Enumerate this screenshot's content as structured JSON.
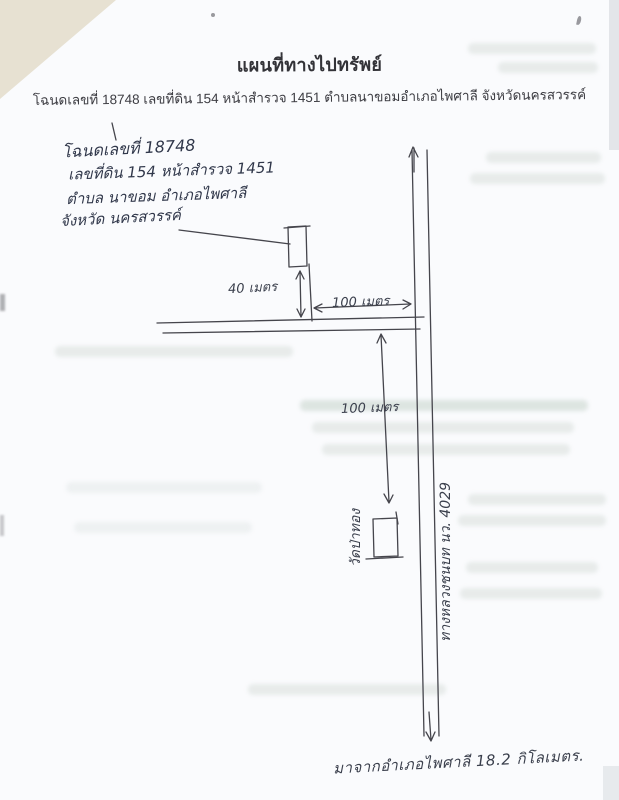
{
  "page": {
    "title": "แผนที่ทางไปทรัพย์",
    "subtitle": "โฉนดเลขที่ 18748 เลขที่ดิน 154 หน้าสำรวจ 1451 ตำบลนาขอมอำเภอไพศาลี จังหวัดนครสวรรค์"
  },
  "handwritten_note": {
    "line1": "โฉนดเลขที่ 18748",
    "line2": "เลขที่ดิน 154 หน้าสำรวจ 1451",
    "line3": "ตำบล นาขอม อำเภอไพศาลี",
    "line4": "จังหวัด นครสวรรค์"
  },
  "map": {
    "label_40m": "40 เมตร",
    "label_100m_horizontal": "100 เมตร",
    "label_100m_vertical": "100 เมตร",
    "temple_label": "วัดป่าทอง",
    "road_label": "ทางหลวงชนบท นว. 4029",
    "bottom_note": "มาจากอำเภอไพศาลี  18.2 กิโลเมตร."
  },
  "colors": {
    "paper": "#fafbfd",
    "printed_text": "#3a3a3e",
    "handwriting_ink": "#30374a",
    "drawing_line": "#45454c",
    "scanner_corner": "#e7e1d2"
  }
}
